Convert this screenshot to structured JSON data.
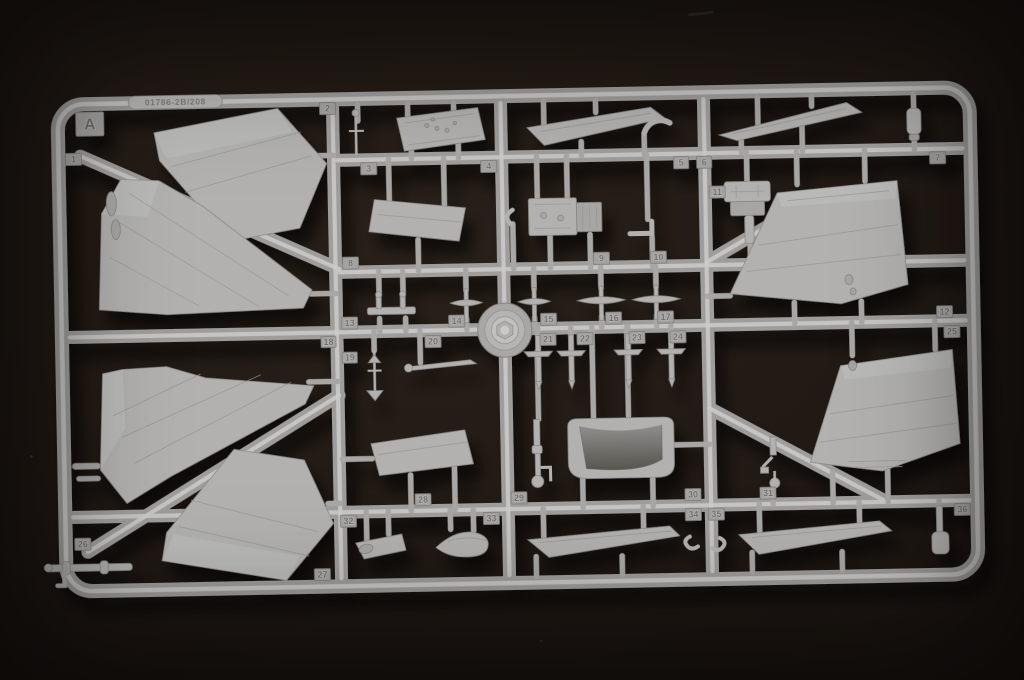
{
  "photo": {
    "background_color": "#1d1612"
  },
  "sprue": {
    "section_letter": "A",
    "mold_stamp": "01786-2B/208",
    "plastic_color": "#b2b1af",
    "runner_color": "#9e9d9b",
    "runner_highlight_color": "#cbcac8",
    "tag_color": "#a3a2a0",
    "tag_text_color": "#6d6c6a",
    "part_numbers": [
      "1",
      "2",
      "3",
      "4",
      "5",
      "6",
      "7",
      "8",
      "9",
      "10",
      "11",
      "12",
      "13",
      "14",
      "15",
      "16",
      "17",
      "18",
      "19",
      "20",
      "21",
      "22",
      "23",
      "24",
      "25",
      "26",
      "27",
      "28",
      "29",
      "30",
      "31",
      "32",
      "33",
      "34",
      "35",
      "36"
    ]
  }
}
